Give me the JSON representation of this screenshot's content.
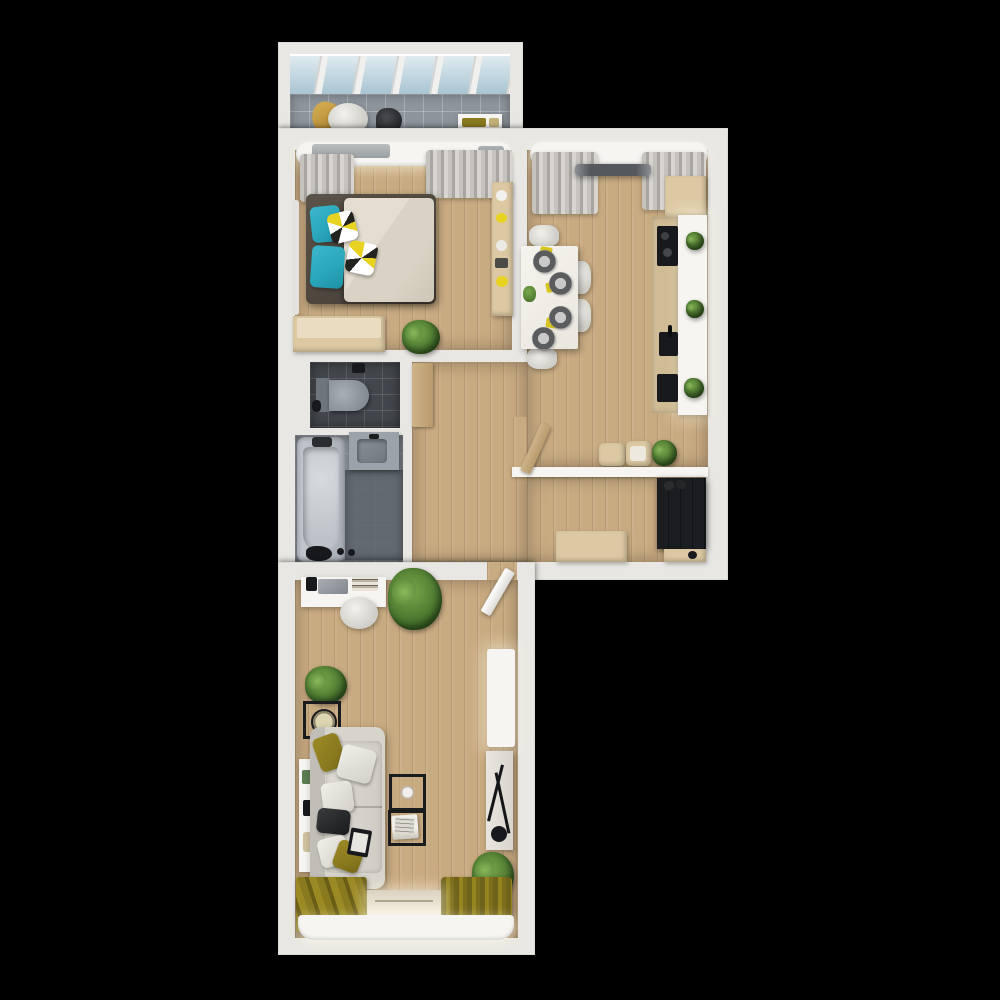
{
  "scene": {
    "type": "3d-apartment-floor-plan-render",
    "view": "top-down",
    "background": "#000000"
  },
  "colors": {
    "background": "#000000",
    "wall": "#e8e7e3",
    "wall_bright": "#f6f5f2",
    "wood_floor": "#c9ab82",
    "balcony_tile": "#8d949b",
    "toilet_floor": "#43474c",
    "bath_floor": "#848b92",
    "bath_floor_dark": "#5d646b",
    "sofa": "#d7d4cc",
    "bed_frame": "#4d463d",
    "duvet": "#dad3c5",
    "teal": "#2aa7bc",
    "olive": "#8a7a1f",
    "yellow": "#e8d222",
    "light_wood": "#dcc9a3",
    "counter_white": "#f6f5f1",
    "dark_unit": "#16181c",
    "appliance_black": "#17191d",
    "plant_dark": "#3e6b27",
    "plant_light": "#7aa84c"
  },
  "rooms": [
    {
      "id": "balcony",
      "items": [
        "glass-roof",
        "tile-floor",
        "lounge-chair",
        "throw-blanket",
        "bag",
        "wall-shelf"
      ]
    },
    {
      "id": "bedroom",
      "items": [
        "window-pelmet",
        "curtains",
        "double-bed",
        "teal-pillows",
        "patterned-pillows",
        "duvet",
        "shelf-unit",
        "dresser",
        "potted-plant",
        "radiator"
      ]
    },
    {
      "id": "kitchen-dining",
      "items": [
        "window-pelmet",
        "curtains",
        "track-light",
        "upper-cabinet",
        "kitchen-counter",
        "cooktop",
        "sink",
        "oven",
        "counter-plants",
        "dining-table",
        "chairs",
        "place-settings",
        "centerpiece",
        "floor-cushions",
        "potted-plant",
        "door"
      ]
    },
    {
      "id": "wc",
      "items": [
        "wall-hung-toilet",
        "wood-door"
      ]
    },
    {
      "id": "bathroom",
      "items": [
        "bathtub",
        "tub-faucet",
        "washbasin",
        "shower-accessories"
      ]
    },
    {
      "id": "hallway",
      "items": [
        "bench",
        "wardrobe",
        "shoes",
        "drawer-cabinet"
      ]
    },
    {
      "id": "living-room",
      "items": [
        "entry-door",
        "desk",
        "desk-chair",
        "laptop",
        "books",
        "large-plant",
        "small-plant",
        "clock-side-table",
        "wall-console",
        "corner-sofa",
        "throw-pillows",
        "tablet",
        "nesting-coffee-tables",
        "magazines",
        "tall-cabinet",
        "sideboard",
        "decor-sculpture",
        "potted-plant",
        "rug",
        "curtains",
        "balcony-door-threshold",
        "window-pelmet"
      ]
    }
  ]
}
